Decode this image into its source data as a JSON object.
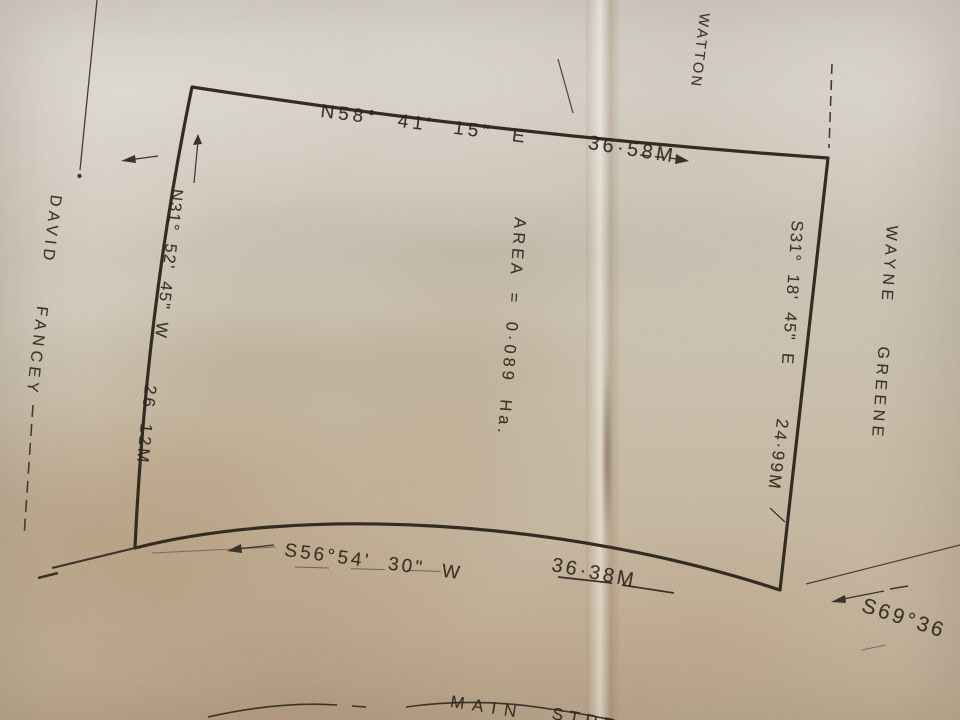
{
  "colors": {
    "ink": "#3a332a",
    "paper": "#c9c0b0"
  },
  "parcel": {
    "area_label": "AREA = 0·089 Ha.",
    "north": {
      "bearing": "N58° 41' 15\" E",
      "distance": "36·58M"
    },
    "east": {
      "bearing": "S31° 18' 45\" E",
      "distance": "24·99M"
    },
    "south": {
      "bearing": "S56°54' 30\" W",
      "distance": "36·38M"
    },
    "west": {
      "bearing": "N31° 52' 45\" W",
      "distance": "26 12M"
    }
  },
  "adjoiners": {
    "west": "DAVID  FANCEY",
    "east": "WAYNE  GREENE",
    "north_partial": "D",
    "north": "WATTON"
  },
  "street": {
    "word1": "MAIN",
    "word2": "STRE"
  },
  "road_bearing": "S69°36"
}
